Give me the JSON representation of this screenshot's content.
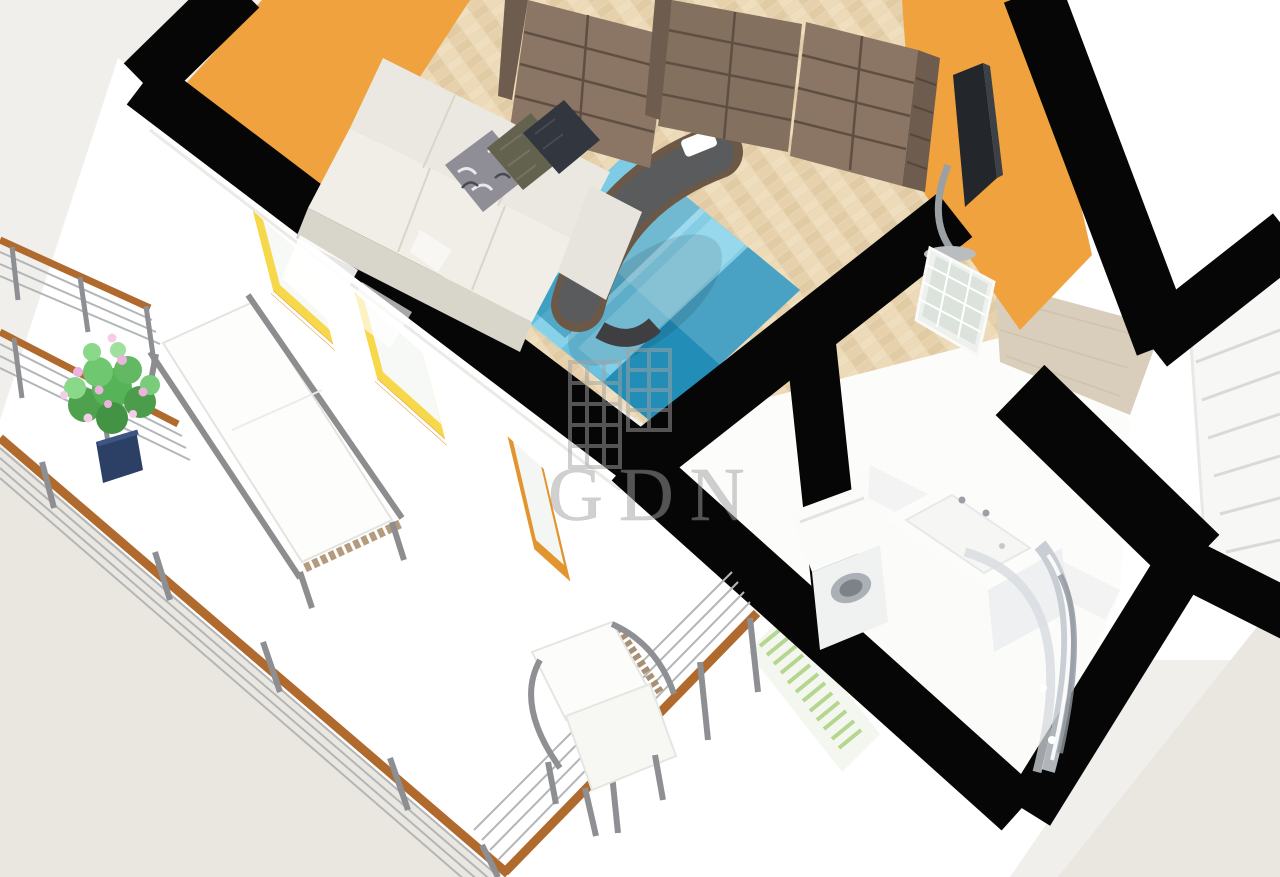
{
  "watermark": {
    "text": "GDN",
    "logo": "buildings-logo"
  },
  "palette": {
    "bg": "#f1efec",
    "ground": "#eae7e1",
    "black": "#060606",
    "white": "#ffffff",
    "offwhite": "#fcfcfb",
    "orange": "#efa23d",
    "reveal_yellow": "#f6d84a",
    "reveal_orange": "#e2952e",
    "parquet": "#e9d6b4",
    "parquet_dark": "#ddc7a0",
    "hall_floor": "#d9cdbb",
    "bath_floor": "#fbfbfa",
    "shelf": "#8b7665",
    "shelf_side": "#6e5c4e",
    "shelf_line": "#5f4f43",
    "sofa": "#eae8e0",
    "sofa_shade": "#d8d5ca",
    "pillow_pattern": "#8f8d96",
    "pillow_olive": "#63624f",
    "pillow_dark": "#32363e",
    "rug_base": "#2ba3cf",
    "rug_light": "#8fd8ef",
    "rug_dark": "#1c7fa6",
    "rug_pale": "#b8e8f4",
    "chaise_wood": "#6b5847",
    "chaise_seat": "#5a5b5d",
    "tv": "#23262b",
    "metal": "#9aa0a4",
    "rail_wood": "#b06a2e",
    "cable": "#b3b6b9",
    "leaf": "#57b357",
    "flower": "#eeb2de",
    "pot": "#2c4066",
    "radiator": "#b5d68e",
    "glass": "#c3c9d0",
    "stair": "#f7f7f6",
    "watermark": "#a2a2a2"
  },
  "scene": {
    "type": "3d-floorplan-render",
    "view": "cutaway dollhouse view from above, rotated diagonally",
    "rooms": [
      "living-room",
      "balcony",
      "bathroom",
      "hallway",
      "staircase"
    ],
    "living_room_items": [
      "sofa-with-three-pillows",
      "bookshelf-wall-units",
      "blue-patchwork-rug",
      "curved-chaise-lounge",
      "tv-on-stand",
      "orange-walls",
      "herringbone-parquet"
    ],
    "balcony_items": [
      "potted-plant-pink-flowers",
      "sun-lounger",
      "armchair",
      "cable-railing-wood-handrail",
      "balcony-windows-yellow-reveal",
      "balcony-door"
    ],
    "bathroom_items": [
      "washing-machine",
      "vanity-sink",
      "curved-shower-enclosure",
      "towel-radiator"
    ],
    "hallway_items": [
      "glazed-interior-door",
      "wood-floor"
    ],
    "staircase_items": [
      "white-stair-treads"
    ]
  }
}
